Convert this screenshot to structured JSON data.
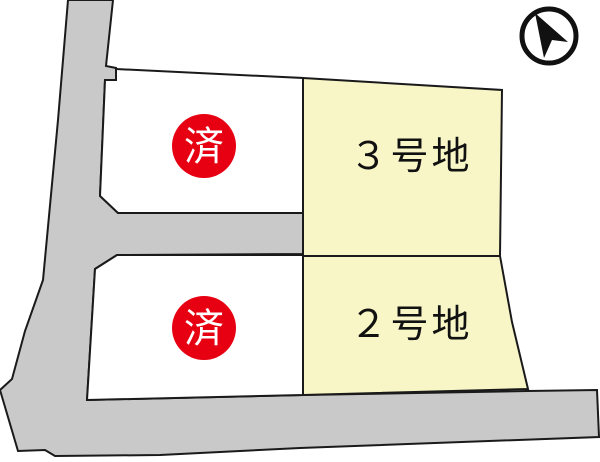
{
  "colors": {
    "road_fill": "#c9c9c9",
    "available_lot_fill": "#f8f5c6",
    "sold_lot_fill": "#ffffff",
    "sold_badge_fill": "#e60012",
    "badge_text": "#ffffff",
    "label_text": "#111111",
    "outline": "#1a1a1a"
  },
  "plots": {
    "lot3": {
      "label": "３号地"
    },
    "lot2": {
      "label": "２号地"
    },
    "sold_upper": {
      "badge": "済"
    },
    "sold_lower": {
      "badge": "済"
    }
  },
  "compass": {
    "icon": "north-arrow"
  }
}
